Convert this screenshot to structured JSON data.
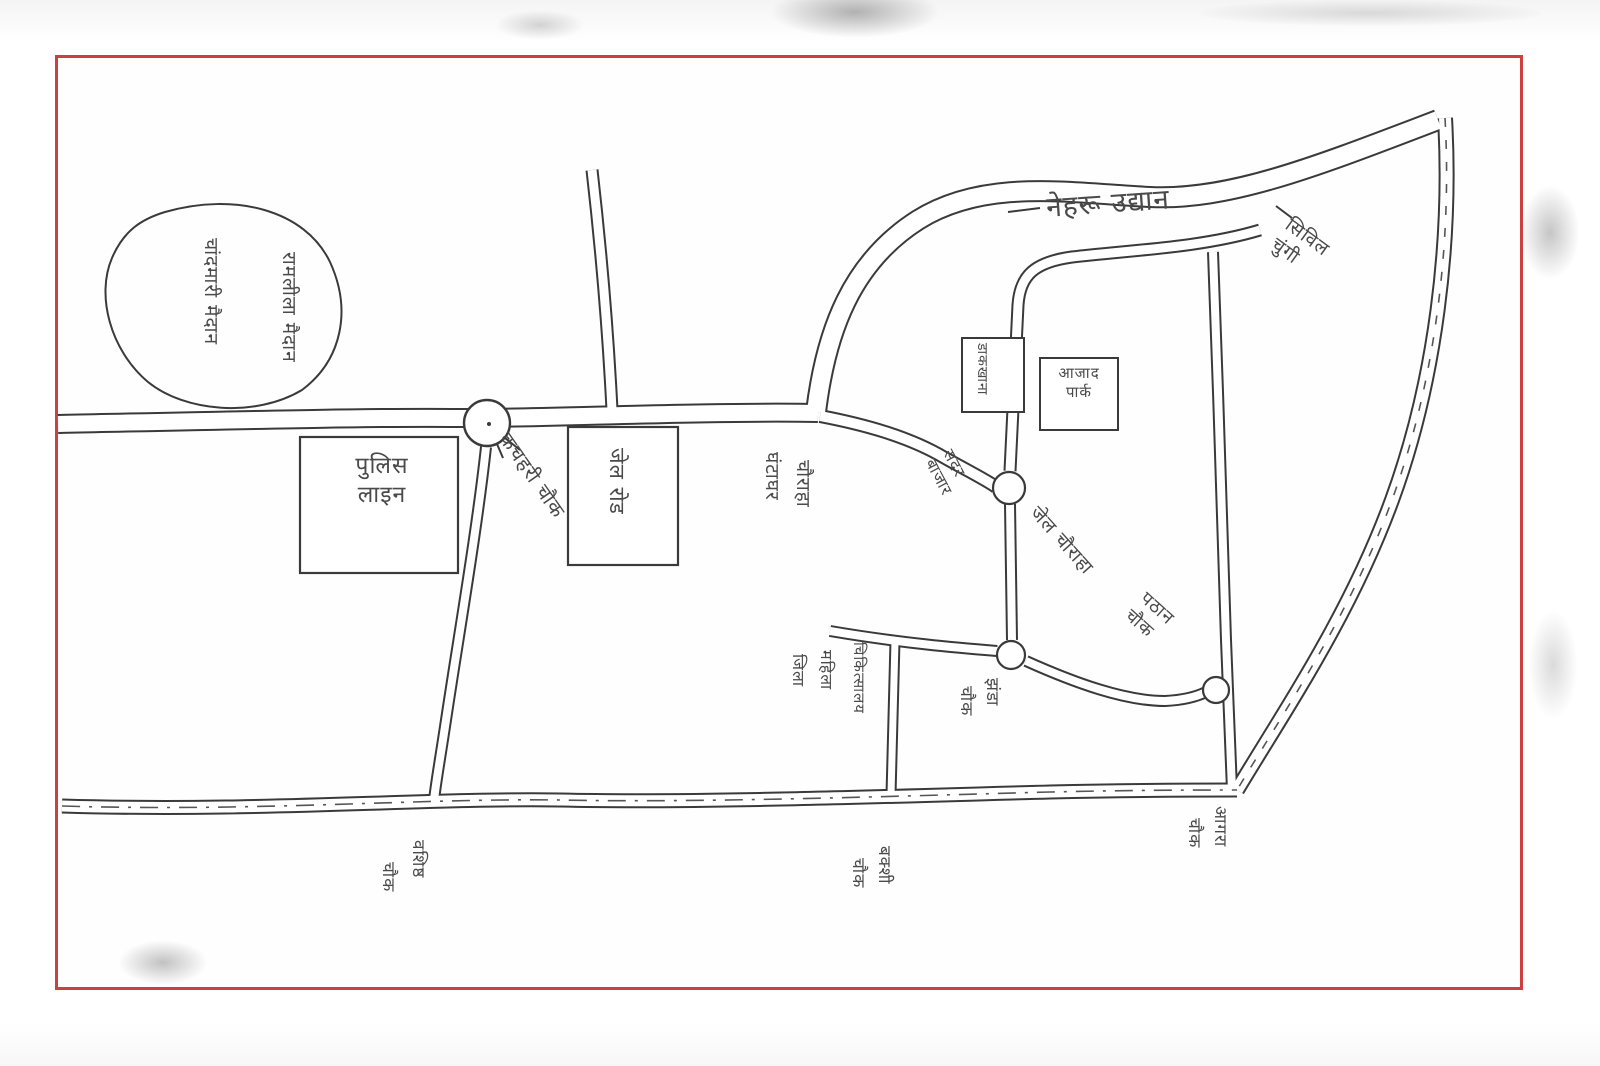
{
  "page": {
    "background": "#ffffff",
    "frame_color": "#cc4040",
    "ink_color": "#3a3a3a",
    "label_color": "#4a4a4a",
    "description": "Hand-drawn city sketch map scan with red border"
  },
  "map": {
    "type": "hand-drawn-sketch-map",
    "labels": [
      {
        "id": "pond-name-line-1",
        "text": "चांदमारी मैदान",
        "x": 222,
        "y": 238,
        "rot": 90,
        "fs": 19
      },
      {
        "id": "pond-name-line-2",
        "text": "रामलीला मैदान",
        "x": 300,
        "y": 252,
        "rot": 90,
        "fs": 19
      },
      {
        "id": "police-line-box-label",
        "lines": [
          "पुलिस",
          "लाइन"
        ],
        "x": 312,
        "y": 452,
        "rot": 0,
        "fs": 23,
        "w": 140,
        "align": "center"
      },
      {
        "id": "kachahari-chowk-label",
        "text": "कचहरी चौक",
        "x": 514,
        "y": 428,
        "rot": 55,
        "fs": 20
      },
      {
        "id": "jail-road-box-label",
        "text": "जेल रोड",
        "x": 630,
        "y": 448,
        "rot": 90,
        "fs": 21
      },
      {
        "id": "ghantaghar-label",
        "text": "घंटाघर",
        "x": 783,
        "y": 452,
        "rot": 90,
        "fs": 19
      },
      {
        "id": "ghantaghar-chauraha-label",
        "text": "चौराहा",
        "x": 814,
        "y": 460,
        "rot": 90,
        "fs": 19
      },
      {
        "id": "sadar-bazar-label",
        "lines": [
          "सदर",
          "बाजार"
        ],
        "x": 956,
        "y": 446,
        "rot": 62,
        "fs": 16
      },
      {
        "id": "nehru-udyan-label",
        "text": "नेहरू उद्यान",
        "x": 1045,
        "y": 190,
        "rot": -4,
        "fs": 28
      },
      {
        "id": "chungi-label",
        "lines": [
          "सिविल",
          "चुंगी"
        ],
        "x": 1294,
        "y": 214,
        "rot": 36,
        "fs": 19
      },
      {
        "id": "dakkhana-box-label",
        "text": "डाकखाना",
        "x": 990,
        "y": 343,
        "rot": 90,
        "fs": 14
      },
      {
        "id": "azad-park-box-label",
        "lines": [
          "आजाद",
          "पार्क"
        ],
        "x": 1044,
        "y": 364,
        "rot": 0,
        "fs": 15,
        "w": 70,
        "align": "center"
      },
      {
        "id": "jail-chauraha-label",
        "text": "जेल चौराहा",
        "x": 1042,
        "y": 502,
        "rot": 48,
        "fs": 19
      },
      {
        "id": "hospital-label-col-1",
        "text": "जिला",
        "x": 808,
        "y": 654,
        "rot": 90,
        "fs": 16
      },
      {
        "id": "hospital-label-col-2",
        "text": "महिला",
        "x": 836,
        "y": 650,
        "rot": 90,
        "fs": 16
      },
      {
        "id": "hospital-label-col-3",
        "text": "चिकित्सालय",
        "x": 868,
        "y": 642,
        "rot": 90,
        "fs": 15
      },
      {
        "id": "jhanda-label",
        "text": "झंडा",
        "x": 1002,
        "y": 678,
        "rot": 90,
        "fs": 17
      },
      {
        "id": "jhanda-chowk-label",
        "text": "चौक",
        "x": 976,
        "y": 686,
        "rot": 90,
        "fs": 17
      },
      {
        "id": "pathan-chowk-label",
        "lines": [
          "पठान",
          "चौक"
        ],
        "x": 1150,
        "y": 588,
        "rot": 42,
        "fs": 18
      },
      {
        "id": "vashisht-label",
        "text": "वशिष्ठ",
        "x": 428,
        "y": 840,
        "rot": 90,
        "fs": 17
      },
      {
        "id": "vashisht-chowk-label",
        "text": "चौक",
        "x": 398,
        "y": 862,
        "rot": 90,
        "fs": 17
      },
      {
        "id": "bakshi-label",
        "text": "बक्शी",
        "x": 894,
        "y": 846,
        "rot": 90,
        "fs": 17
      },
      {
        "id": "bakshi-chowk-label",
        "text": "चौक",
        "x": 868,
        "y": 858,
        "rot": 90,
        "fs": 17
      },
      {
        "id": "agra-label",
        "text": "आगरा",
        "x": 1230,
        "y": 806,
        "rot": 90,
        "fs": 17
      },
      {
        "id": "agra-chowk-label",
        "text": "चौक",
        "x": 1204,
        "y": 818,
        "rot": 90,
        "fs": 17
      }
    ]
  }
}
